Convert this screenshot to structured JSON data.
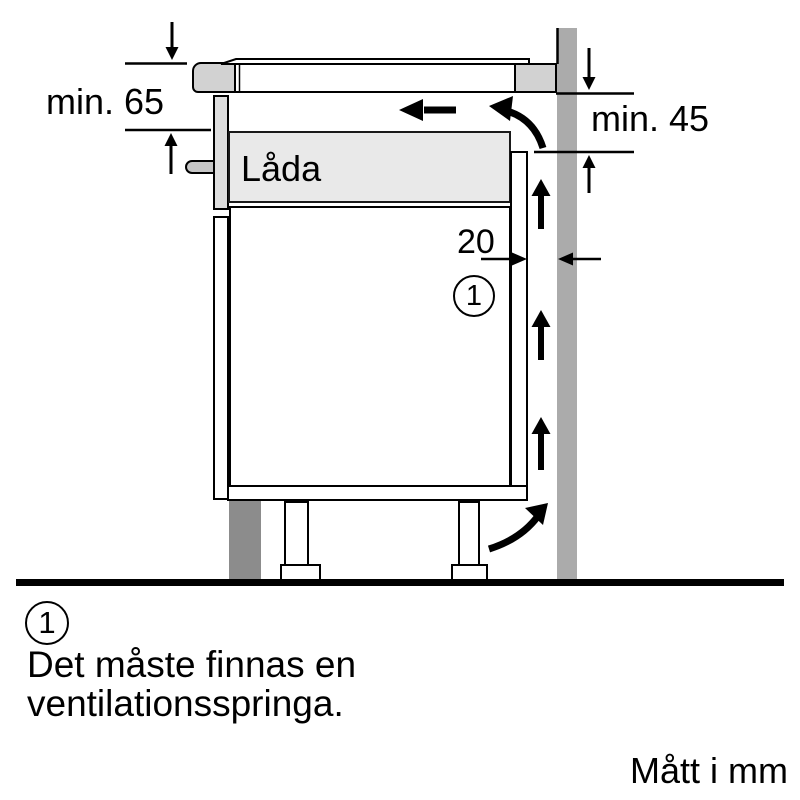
{
  "dimensions": {
    "clearance_left_label": "min. 65",
    "clearance_right_label": "min. 45",
    "vent_gap_label": "20",
    "units_note": "Mått i mm"
  },
  "drawer_label": "Låda",
  "callout": {
    "marker": "1"
  },
  "footnote": {
    "marker": "1",
    "line1": "Det måste finnas en",
    "line2": "ventilationsspringa."
  },
  "colors": {
    "wall": "#ababab",
    "plinth": "#8c8c8c",
    "hob_edge": "#d2d2d2",
    "worktop_cut": "#d2d2d2",
    "drawer_fill": "#e9e9e9",
    "drawer_front": "#dedede",
    "handle": "#c6c6c6",
    "line": "#000000"
  }
}
